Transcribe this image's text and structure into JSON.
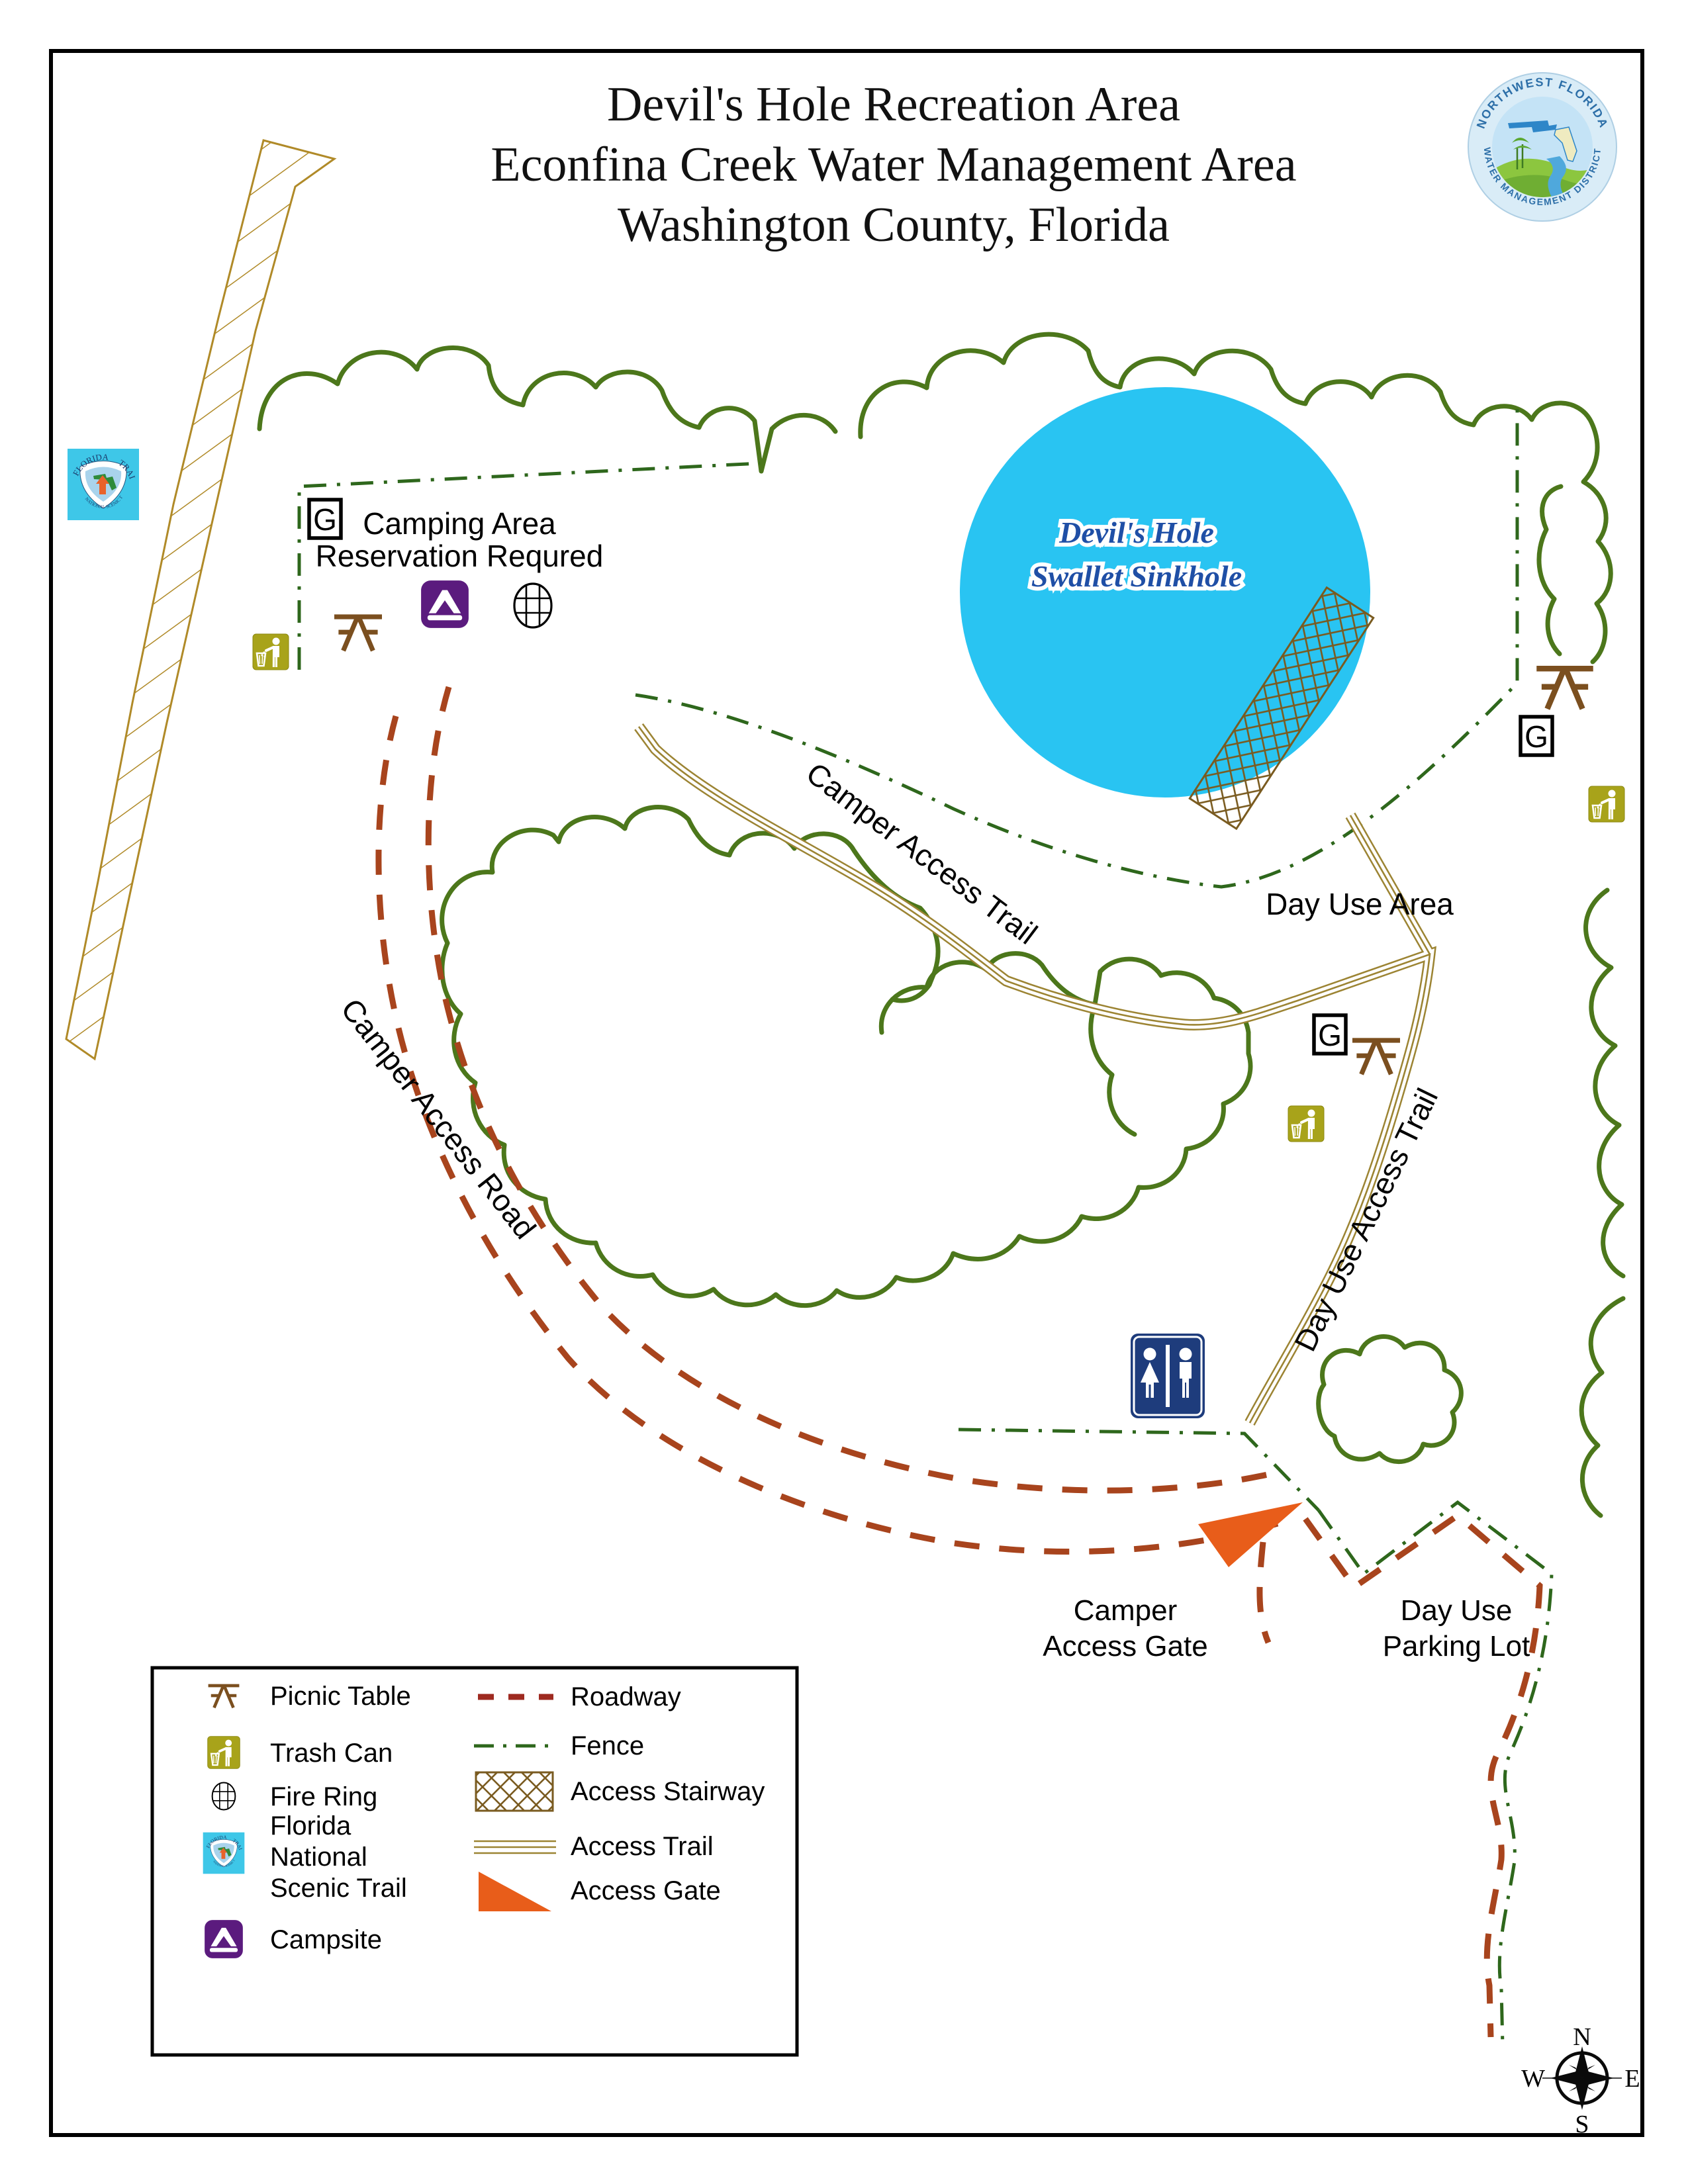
{
  "title": {
    "line1": "Devil's Hole Recreation Area",
    "line2": "Econfina Creek Water Management Area",
    "line3": "Washington County, Florida"
  },
  "nwfwmd_logo": {
    "arc_top": "NORTHWEST FLORIDA",
    "arc_bottom": "WATER MANAGEMENT DISTRICT"
  },
  "florida_trail_logo": {
    "arc_top_left": "FLORIDA",
    "arc_top_right": "TRAIL",
    "arc_bottom": "NATIONAL SCENIC TRAIL"
  },
  "map": {
    "sinkhole_line1": "Devil's Hole",
    "sinkhole_line2": "Swallet Sinkhole",
    "camping_line1": "Camping Area",
    "camping_line2": "Reservation Requred",
    "day_use_area": "Day Use Area",
    "camper_access_trail": "Camper Access Trail",
    "camper_access_road": "Camper Access Road",
    "day_use_access_trail": "Day Use Access Trail",
    "camper_gate_line1": "Camper",
    "camper_gate_line2": "Access Gate",
    "parking_line1": "Day Use",
    "parking_line2": "Parking Lot",
    "g_sign": "G"
  },
  "legend": {
    "left": [
      {
        "label": "Picnic Table"
      },
      {
        "label": "Trash Can"
      },
      {
        "label": "Fire Ring"
      },
      {
        "line1": "Florida",
        "line2": "National",
        "line3": "Scenic Trail"
      },
      {
        "label": "Campsite"
      }
    ],
    "right": [
      {
        "label": "Roadway"
      },
      {
        "label": "Fence"
      },
      {
        "label": "Access Stairway"
      },
      {
        "label": "Access Trail"
      },
      {
        "label": "Access Gate"
      }
    ]
  },
  "compass": {
    "n": "N",
    "s": "S",
    "e": "E",
    "w": "W"
  },
  "colors": {
    "tree_outline": "#4C771B",
    "fence": "#2E671C",
    "roadway": "#A8441D",
    "access_trail": "#9C8433",
    "stairway_brown": "#7A5B20",
    "fnst_band": "#B08A28",
    "sinkhole_fill": "#29C4F2",
    "sinkhole_text": "#1F4FA6",
    "picnic_brown": "#7B4F1F",
    "trash_olive": "#A8A31A",
    "campsite_purple": "#5B1B7E",
    "restroom_navy": "#1E3C7C",
    "gate_orange": "#E85D1A"
  }
}
